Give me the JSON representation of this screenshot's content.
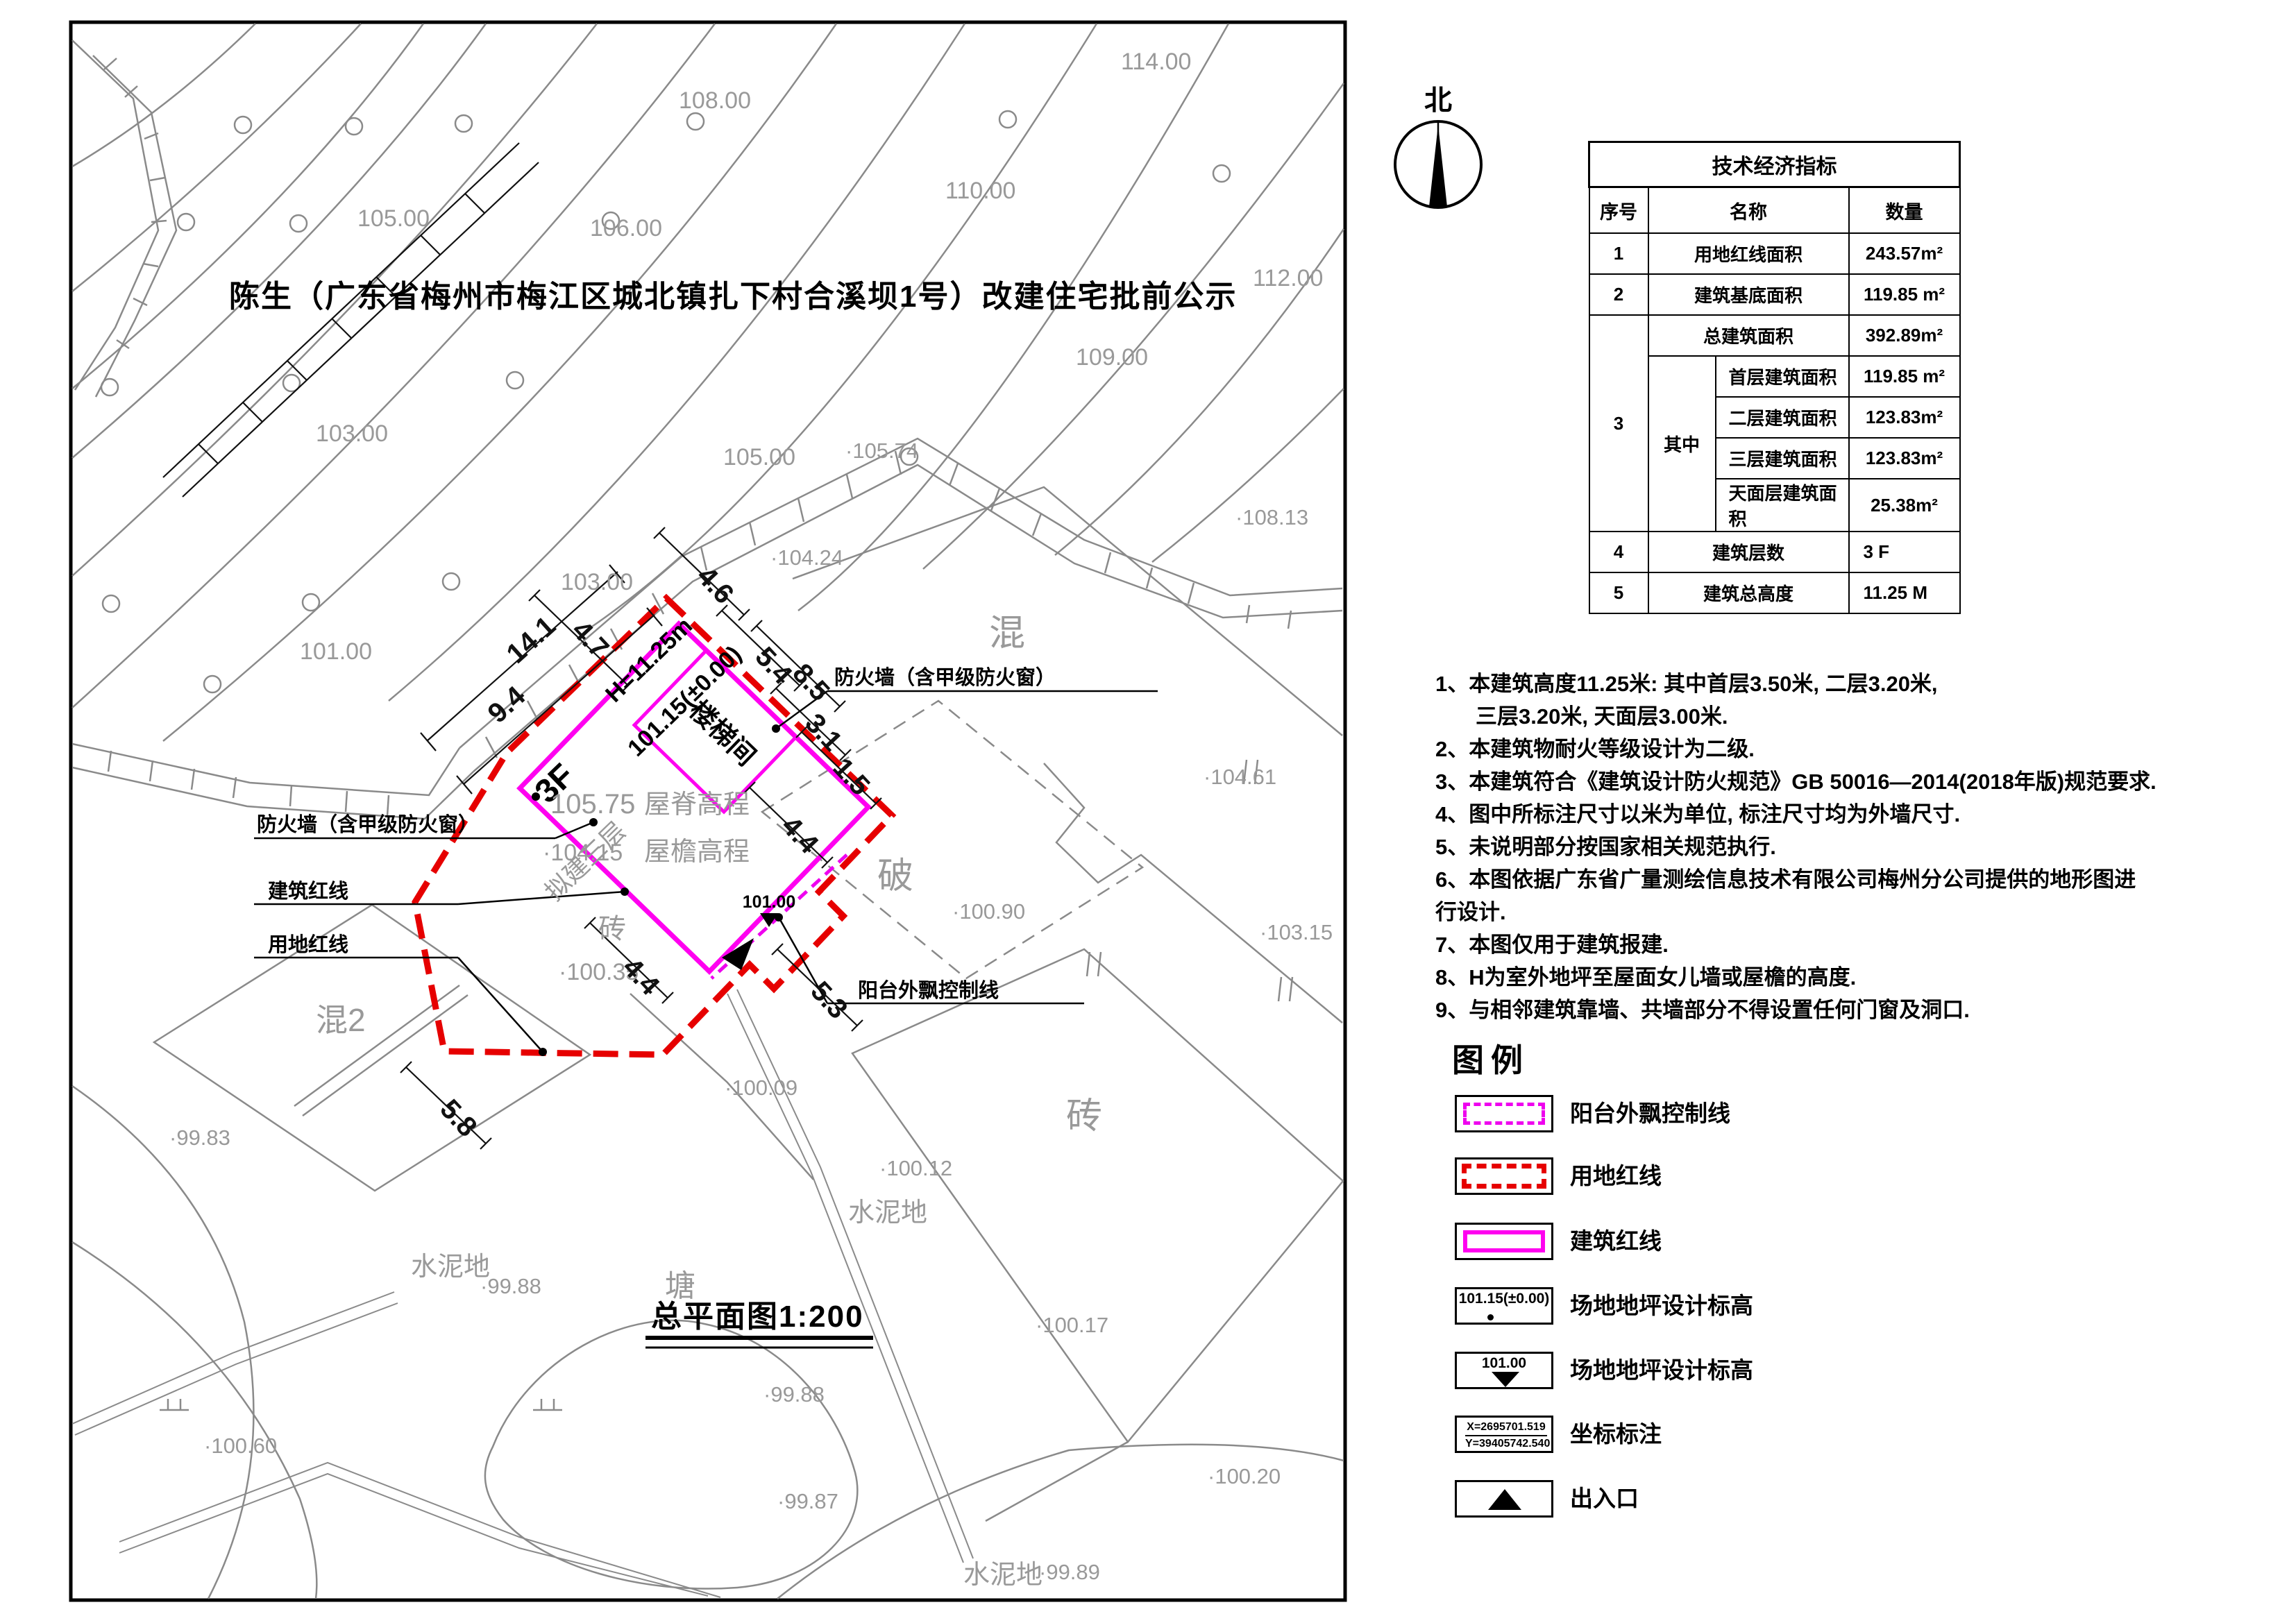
{
  "page": {
    "notice_title": "陈生（广东省梅州市梅江区城北镇扎下村合溪坝1号）改建住宅批前公示",
    "drawing_title": "总平面图1:200",
    "north_label": "北"
  },
  "table": {
    "title": "技术经济指标",
    "col_index": "序号",
    "col_name": "名称",
    "col_qty": "数量",
    "r1": {
      "no": "1",
      "name": "用地红线面积",
      "qty": "243.57m²"
    },
    "r2": {
      "no": "2",
      "name": "建筑基底面积",
      "qty": "119.85 m²"
    },
    "r3": {
      "no": "3",
      "total_name": "总建筑面积",
      "total_qty": "392.89m²",
      "among": "其中",
      "sub": [
        {
          "name": "首层建筑面积",
          "qty": "119.85 m²"
        },
        {
          "name": "二层建筑面积",
          "qty": "123.83m²"
        },
        {
          "name": "三层建筑面积",
          "qty": "123.83m²"
        },
        {
          "name": "天面层建筑面积",
          "qty": "25.38m²"
        }
      ]
    },
    "r4": {
      "no": "4",
      "name": "建筑层数",
      "qty": "3 F"
    },
    "r5": {
      "no": "5",
      "name": "建筑总高度",
      "qty": "11.25 M"
    }
  },
  "notes": {
    "items": [
      "1、本建筑高度11.25米: 其中首层3.50米, 二层3.20米,",
      "三层3.20米, 天面层3.00米.",
      "2、本建筑物耐火等级设计为二级.",
      "3、本建筑符合《建筑设计防火规范》GB 50016—2014(2018年版)规范要求.",
      "4、图中所标注尺寸以米为单位, 标注尺寸均为外墙尺寸.",
      "5、未说明部分按国家相关规范执行.",
      "6、本图依据广东省广量测绘信息技术有限公司梅州分公司提供的地形图进行设计.",
      "7、本图仅用于建筑报建.",
      "8、H为室外地坪至屋面女儿墙或屋檐的高度.",
      "9、与相邻建筑靠墙、共墙部分不得设置任何门窗及洞口."
    ]
  },
  "legend": {
    "title": "图例",
    "items": [
      {
        "label": "阳台外飘控制线"
      },
      {
        "label": "用地红线"
      },
      {
        "label": "建筑红线"
      },
      {
        "label": "室内地坪设计标高",
        "value": "101.15(±0.00)"
      },
      {
        "label": "场地地坪设计标高",
        "value": "101.00"
      },
      {
        "label": "坐标标注",
        "x": "X=2695701.519",
        "y": "Y=39405742.540"
      },
      {
        "label": "出入口"
      }
    ]
  },
  "plan": {
    "contours": [
      "114.00",
      "108.00",
      "110.00",
      "105.00",
      "106.00",
      "112.00",
      "109.00",
      "103.00",
      "105.00",
      "103.00",
      "101.00"
    ],
    "spots": [
      "·105.74",
      "·104.24",
      "·108.13",
      "·104.61",
      "·103.15",
      "·100.90",
      "·100.09",
      "·100.12",
      "·100.17",
      "·100.20",
      "·99.83",
      "·99.88",
      "·99.88",
      "·100.60",
      "·99.87",
      "·99.89"
    ],
    "areas": [
      "混",
      "破",
      "混2",
      "砖",
      "砖",
      "水泥地",
      "水泥地",
      "水泥地",
      "塘"
    ],
    "dims": [
      "14.1",
      "9.4",
      "4.7",
      "4.6",
      "5.4",
      "8.5",
      "3.1",
      "1.5",
      "4.4",
      "4.4",
      "5.3",
      "5.8"
    ],
    "building": {
      "floors": "3F",
      "height": "H=11.25m",
      "indoor_level": "101.15(±0.00)",
      "stair": "楼梯间",
      "plan_floors": "拟建三层",
      "ridge_level": "105.75",
      "ridge_label": "屋脊高程",
      "eave_level": "·104.15",
      "eave_label": "屋檐高程",
      "ground": "·100.35",
      "entry_level": "101.00"
    },
    "callouts": {
      "firewall": "防火墙（含甲级防火窗）",
      "building_line": "建筑红线",
      "site_line": "用地红线",
      "balcony_line": "阳台外飘控制线"
    }
  }
}
